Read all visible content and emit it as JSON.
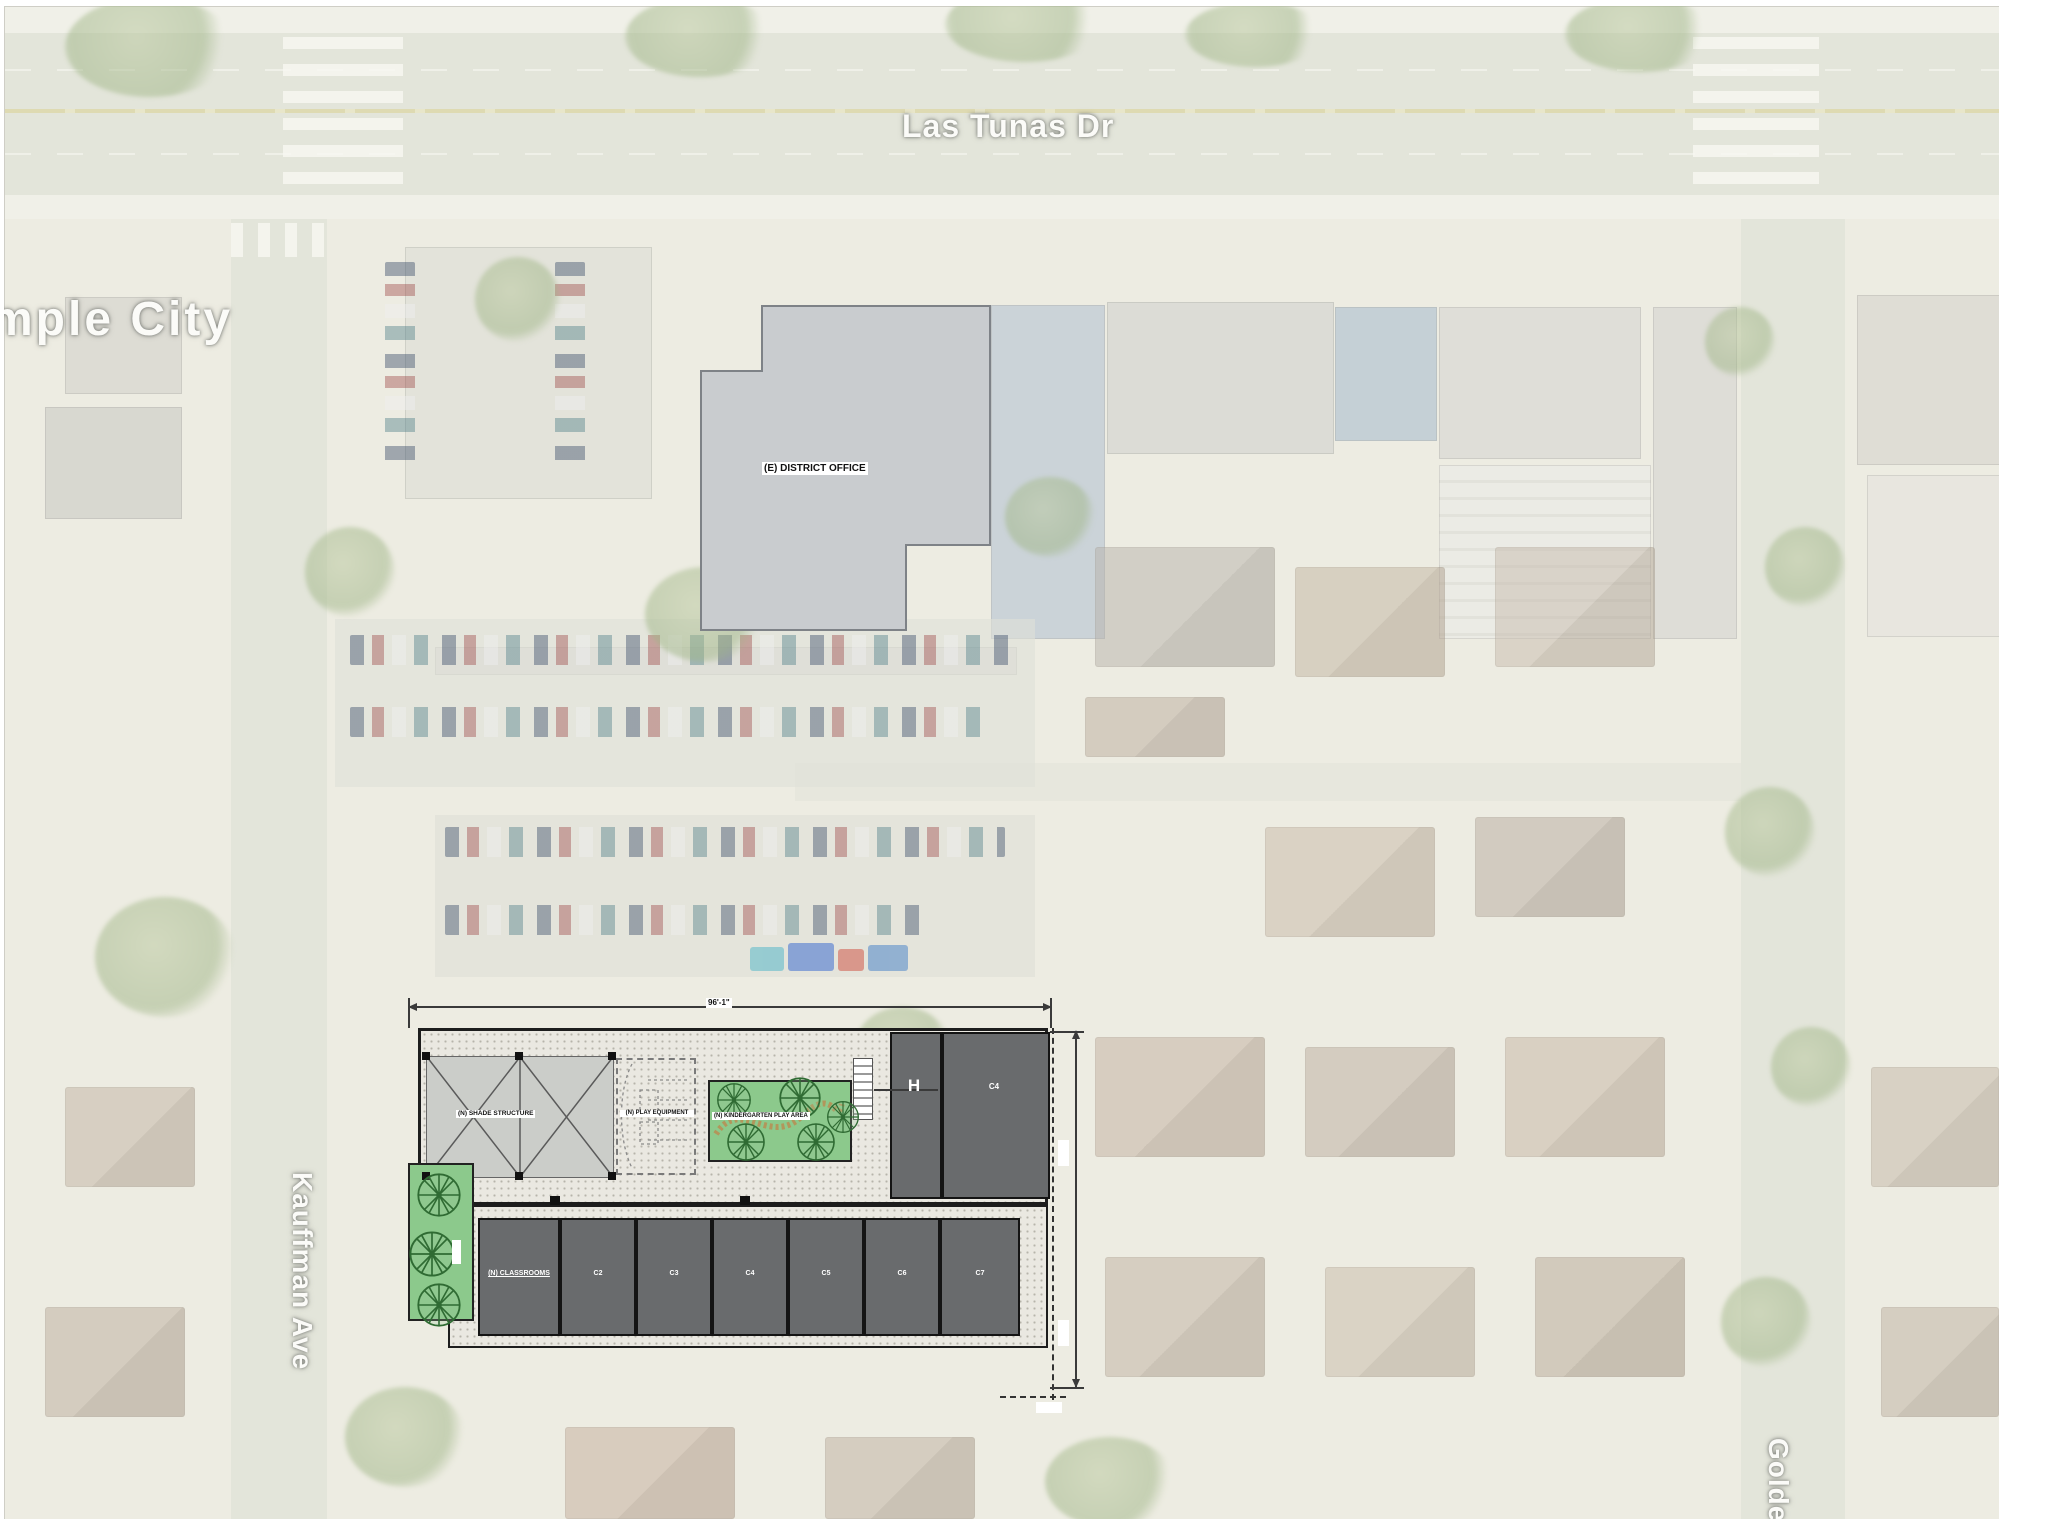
{
  "map": {
    "labels": {
      "main_road": "Las Tunas Dr",
      "city_partial": "mple City",
      "left_street": "Kauffman Ave",
      "bottom_right_street_partial": "Golde"
    },
    "existing_building_label": "(E) DISTRICT OFFICE"
  },
  "site_plan": {
    "top_dimension": "96'-1\"",
    "shade_structure_label": "(N) SHADE STRUCTURE",
    "play_equipment_label": "(N) PLAY EQUIPMENT",
    "kindergarten_label": "(N) KINDERGARTEN PLAY AREA",
    "building_h_label": "H",
    "building_c_label": "C4",
    "classroom_units": [
      {
        "label": "(N) CLASSROOMS"
      },
      {
        "label": "C2"
      },
      {
        "label": "C3"
      },
      {
        "label": "C4"
      },
      {
        "label": "C5"
      },
      {
        "label": "C6"
      },
      {
        "label": "C7"
      }
    ]
  },
  "colors": {
    "plan_dark_building": "#696b6d",
    "plan_green": "#8cc98c",
    "plan_courtyard": "#eae8e1",
    "district_office_fill": "#c9cccf",
    "road": "#e3e5da",
    "map_label": "#fbfbf8"
  }
}
